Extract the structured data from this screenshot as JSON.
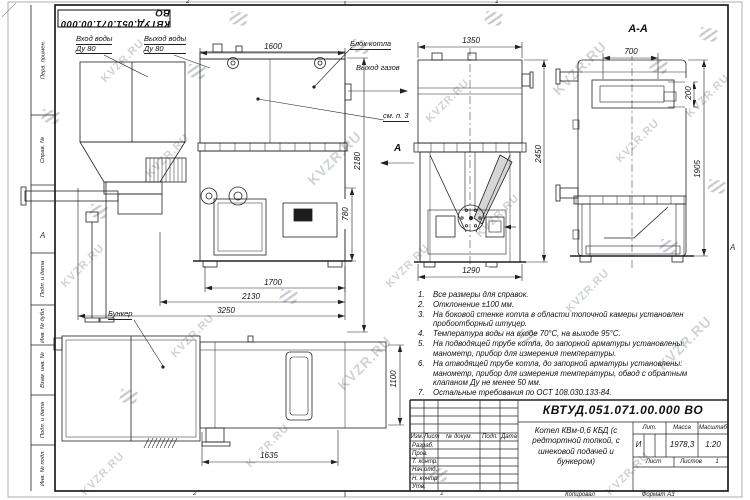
{
  "watermark": {
    "text": "KVZR.RU"
  },
  "stamp": {
    "doc_number_rotated": "КВТУД.051.071.00.000 ВО"
  },
  "zones": {
    "top_left": "2",
    "top_right": "1",
    "bottom_left": "2",
    "bottom_right": "1",
    "left": "А",
    "right": "А"
  },
  "frame_columns": [
    {
      "label": "Перв. примен."
    },
    {
      "label": "Справ. №"
    },
    {
      "label": "Подп. и дата"
    },
    {
      "label": "Инв. № дубл."
    },
    {
      "label": "Взам. инв. №"
    },
    {
      "label": "Подп. и дата"
    },
    {
      "label": "Инв. № подл."
    }
  ],
  "labels": {
    "water_in1": "Вход воды",
    "water_in2": "Ду 80",
    "water_out1": "Выход воды",
    "water_out2": "Ду 80",
    "boiler_block": "Блок котла",
    "gas_out": "Выход газов",
    "see_note": "см. п. 3",
    "view_arrow": "А",
    "section_title": "А-А",
    "bunker": "Бункер"
  },
  "dims": {
    "d1600": "1600",
    "d1350": "1350",
    "d700": "700",
    "d200": "200",
    "d2450": "2450",
    "d1905": "1905",
    "d2180": "2180",
    "d780": "780",
    "d1700": "1700",
    "d2130": "2130",
    "d3250": "3250",
    "d1290": "1290",
    "d1100": "1100",
    "d1635": "1635"
  },
  "notes": {
    "items": [
      {
        "n": "1.",
        "t": "Все размеры для справок."
      },
      {
        "n": "2.",
        "t": "Отклонение ±100 мм."
      },
      {
        "n": "3.",
        "t": "На боковой стенке котла в области топочной камеры установлен пробоотборный штуцер."
      },
      {
        "n": "4.",
        "t": "Температура воды на входе 70°С, на выходе 95°С."
      },
      {
        "n": "5.",
        "t": "На подводящей трубе котла, до запорной арматуры установлены: манометр, прибор для измерения температуры."
      },
      {
        "n": "6.",
        "t": "На отводящей трубе котла, до запорной арматуры установлены: манометр, прибор для измерения температуры, обвод с обратным клапаном Ду не менее 50 мм."
      },
      {
        "n": "7.",
        "t": "Остальные требования по ОСТ 108.030.133-84."
      }
    ]
  },
  "title_block": {
    "doc_number": "КВТУД.051.071.00.000 ВО",
    "name": "Котел КВм-0,6 КБД (с редтортной топкой, с шнековой подачей и бункером)",
    "header_cells": [
      "Изм.",
      "Лист",
      "№ докум.",
      "Подп.",
      "Дата"
    ],
    "rows": [
      "Разраб.",
      "Пров.",
      "Т. контр.",
      "Нач.отд.",
      "Н. контр.",
      "Утв."
    ],
    "lit_header": "Лит.",
    "mass_header": "Масса",
    "scale_header": "Масштаб",
    "lit_value": "И",
    "mass_value": "1978,3",
    "scale_value": "1:20",
    "sheet_label": "Лист",
    "sheets_label": "Листов",
    "sheets_value": "1",
    "copied_label": "Копировал",
    "format_label": "Формат А3"
  }
}
